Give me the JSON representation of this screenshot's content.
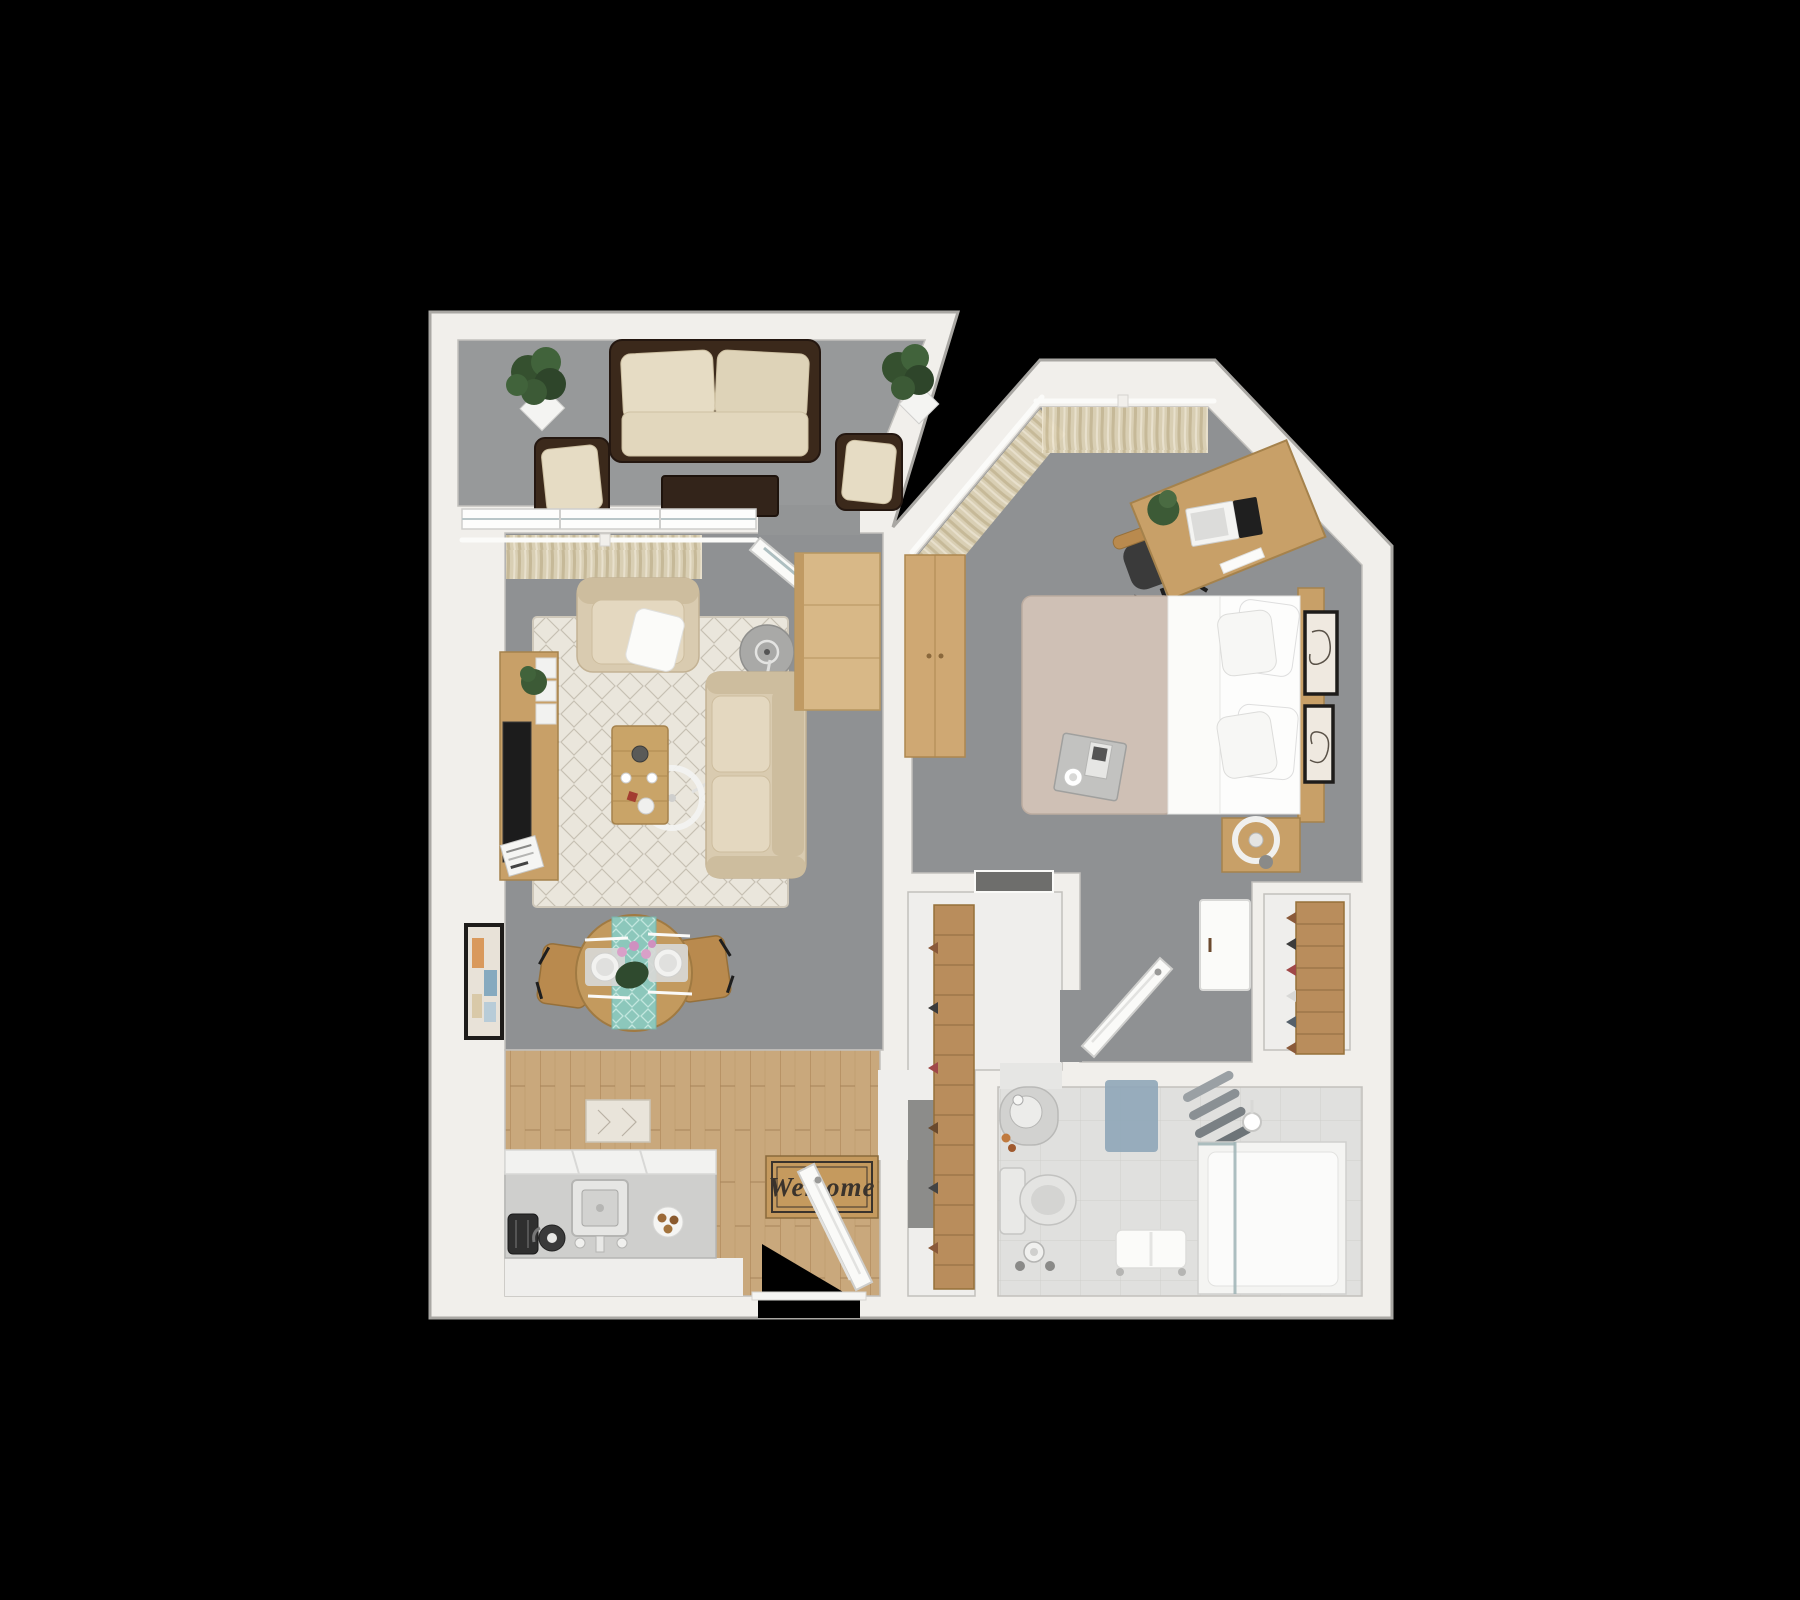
{
  "scene": {
    "type": "3d-floor-plan-render",
    "background": "#000000",
    "view": "top-down dollhouse view of a one-bedroom apartment"
  },
  "doormat": {
    "text": "Welcome"
  },
  "palette": {
    "background": "#000000",
    "wall": "#f1efeb",
    "wall_edge": "#a9a7a3",
    "carpet_gray": "#8f9193",
    "balcony_carpet": "#97999a",
    "wood_floor": "#c9a87c",
    "wood_dark": "#b08a5c",
    "hall_floor": "#efeeec",
    "bathroom_tile": "#e0e0de",
    "rug_cream": "#eae6dc",
    "sofa_beige": "#d9cbb0",
    "wicker_brown": "#3b291b",
    "cushion_cream": "#e6dcc4",
    "duvet_taupe": "#cfc0b5",
    "furniture_wood": "#c8a068",
    "curtain_beige": "#ddd2b6",
    "runner_teal": "#8cc7bb",
    "bath_mat_blue": "#8fa6b8",
    "door_white": "#fafaf8"
  },
  "rooms": [
    {
      "name": "balcony"
    },
    {
      "name": "living-room"
    },
    {
      "name": "dining-area"
    },
    {
      "name": "kitchen"
    },
    {
      "name": "entry"
    },
    {
      "name": "hallway"
    },
    {
      "name": "pantry-closet"
    },
    {
      "name": "bedroom"
    },
    {
      "name": "bedroom-closet"
    },
    {
      "name": "bathroom"
    }
  ],
  "furniture": [
    "outdoor-sofa",
    "outdoor-armchair-left",
    "outdoor-armchair-right",
    "outdoor-coffee-table",
    "potted-plant-balcony-left",
    "potted-plant-balcony-right",
    "tv-console",
    "tv",
    "armchair",
    "side-table",
    "arc-floor-lamp",
    "area-rug",
    "sofa",
    "coffee-table",
    "dining-table",
    "dining-chair-left",
    "dining-chair-right",
    "wall-art-living",
    "kitchen-counter",
    "sink",
    "toaster",
    "kettle",
    "breakfast-plate",
    "kitchen-rug",
    "welcome-mat",
    "entry-door",
    "pantry-shelves",
    "wall-niche",
    "bed",
    "pillows",
    "breakfast-tray",
    "nightstand",
    "ring-lamp",
    "wardrobe",
    "dresser-cabinet",
    "desk",
    "laptop",
    "desk-chair",
    "desk-plant",
    "bedroom-door",
    "closet-shelves",
    "white-cabinet",
    "wall-art-bedroom-1",
    "wall-art-bedroom-2",
    "curtains",
    "bathroom-sink",
    "toilet",
    "toilet-paper-stand",
    "bath-mat",
    "towel-rack",
    "towel-bench",
    "shower"
  ]
}
